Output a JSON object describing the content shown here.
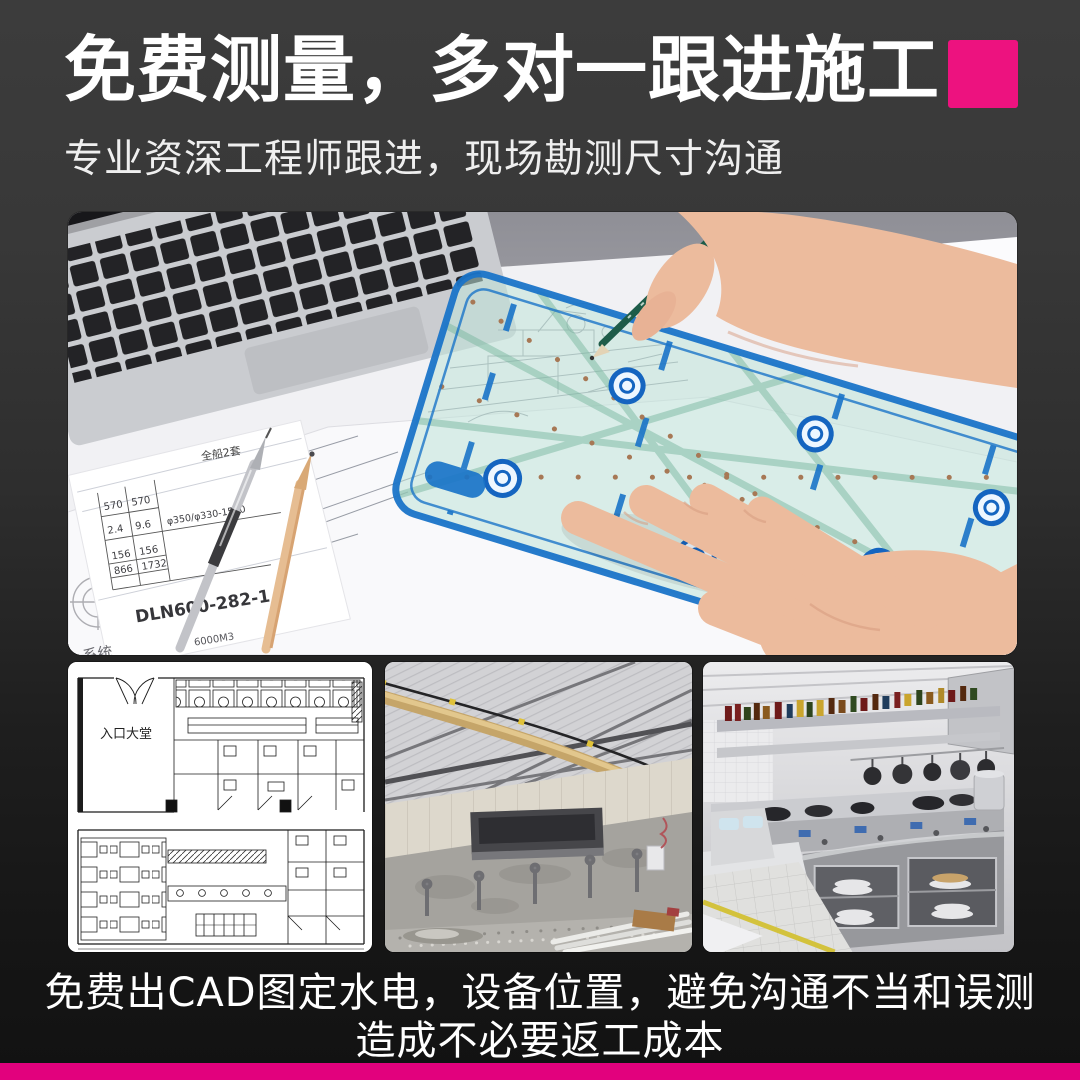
{
  "colors": {
    "background_top": "#3c3c3c",
    "background_bottom": "#121212",
    "accent_square_pink": "#ED127F",
    "bottom_bar_pink": "#E2017D",
    "headline_white": "#ffffff"
  },
  "header": {
    "title": "免费测量，多对一跟进施工",
    "subtitle": "专业资深工程师跟进，现场勘测尺寸沟通"
  },
  "hero": {
    "blueprint": {
      "set_label": "全船2套",
      "rows": [
        [
          "570",
          "570"
        ],
        [
          "2.4",
          "9.6"
        ],
        [
          "156",
          "156"
        ],
        [
          "866",
          "1732"
        ]
      ],
      "spec": "φ350/φ330-1500",
      "drawing_no": "DLN600-282-1",
      "system_label": "系统",
      "volume_note": "6000M3"
    }
  },
  "gallery": {
    "floor_plan_label": "入口大堂"
  },
  "footer": {
    "line1": "免费出CAD图定水电，设备位置，避免沟通不当和误测",
    "line2": "造成不必要返工成本"
  }
}
